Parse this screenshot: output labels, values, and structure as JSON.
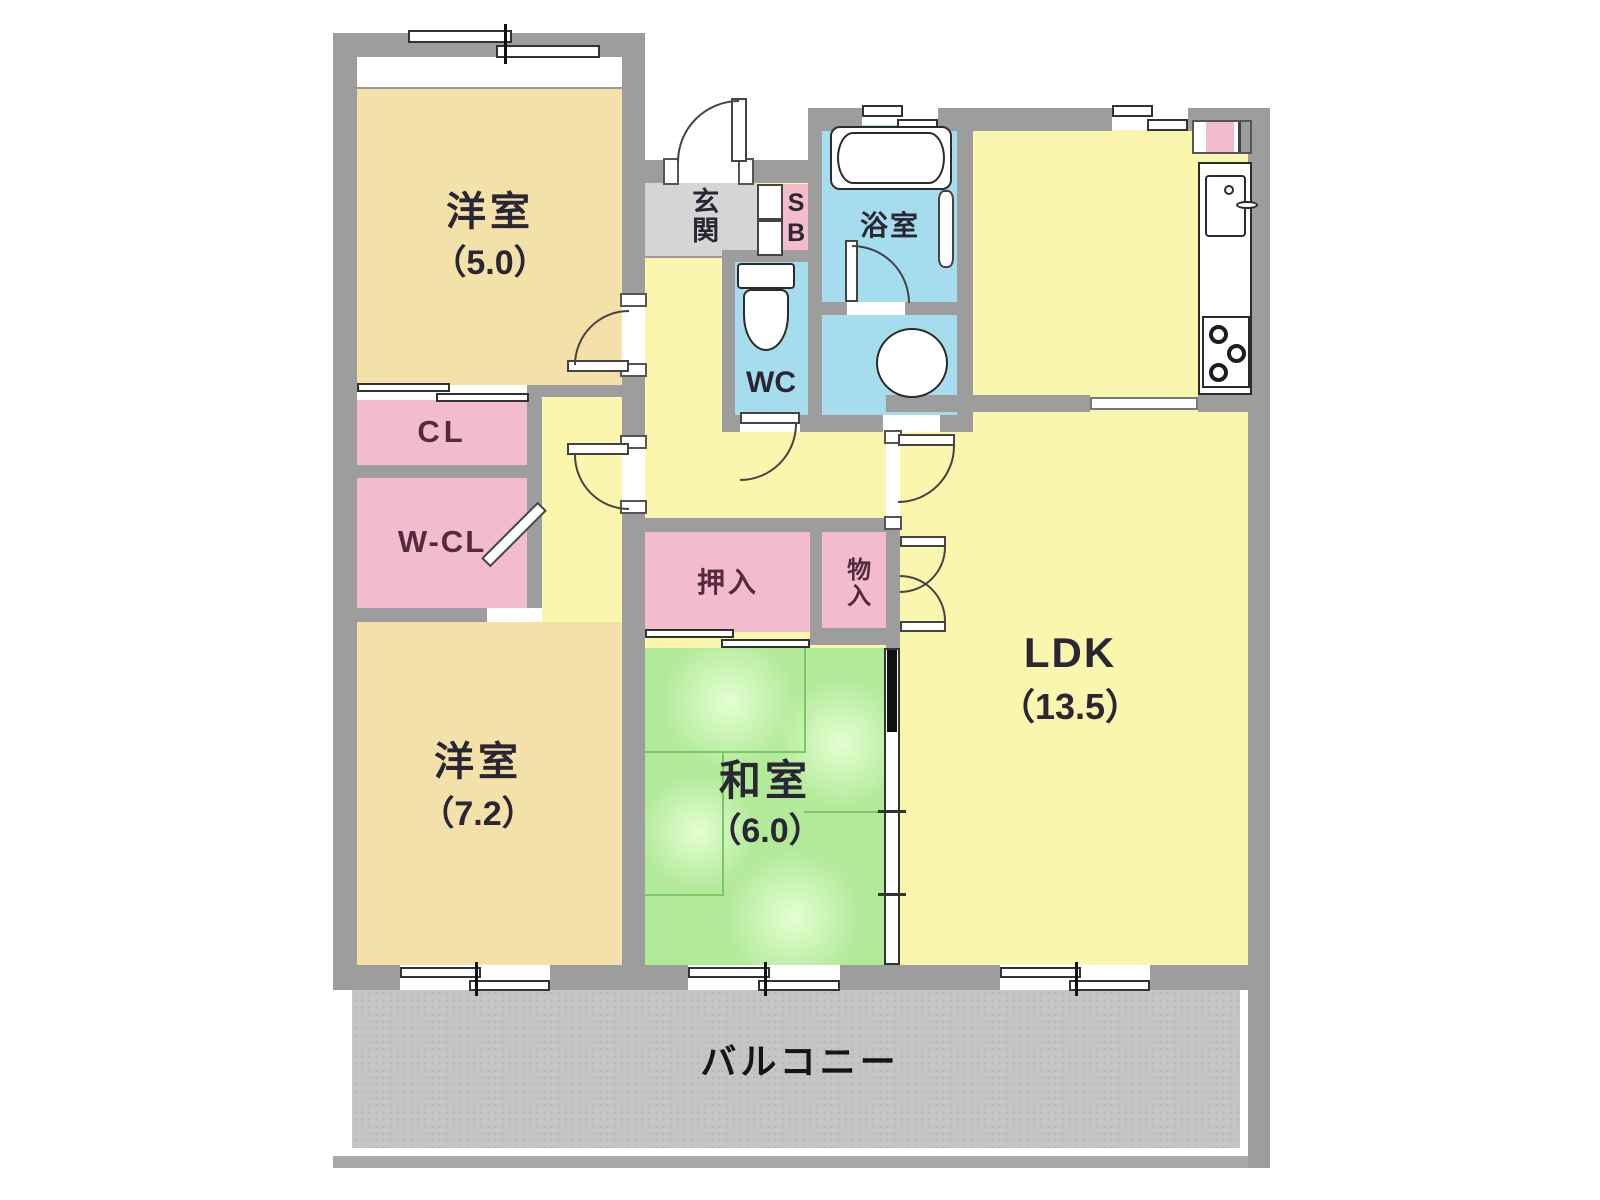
{
  "colors": {
    "wall": "#9d9d9d",
    "cream": "#f4e1a9",
    "yellow": "#faf6ae",
    "pink": "#f2bccd",
    "blue": "#a5dcee",
    "green": "#b2ea9a",
    "greenLine": "#7cc765",
    "entrance": "#d5d5d5",
    "balcony": "#c5c5c5",
    "label": "#2b2633",
    "closetLabel": "#552a40"
  },
  "rooms": {
    "west_room_5": {
      "label": "洋室",
      "size": "（5.0）"
    },
    "entrance": {
      "label": "玄関"
    },
    "shoe_box": {
      "label": "SB"
    },
    "bathroom": {
      "label": "浴室"
    },
    "toilet": {
      "label": "WC"
    },
    "closet": {
      "label": "CL"
    },
    "walkin_closet": {
      "label": "W-CL"
    },
    "west_room_7": {
      "label": "洋室",
      "size": "（7.2）"
    },
    "oshiire": {
      "label": "押入"
    },
    "storage": {
      "label": "物入"
    },
    "japanese_room": {
      "label": "和室",
      "size": "（6.0）"
    },
    "ldk": {
      "label": "LDK",
      "size": "（13.5）"
    },
    "balcony": {
      "label": "バルコニー"
    }
  }
}
